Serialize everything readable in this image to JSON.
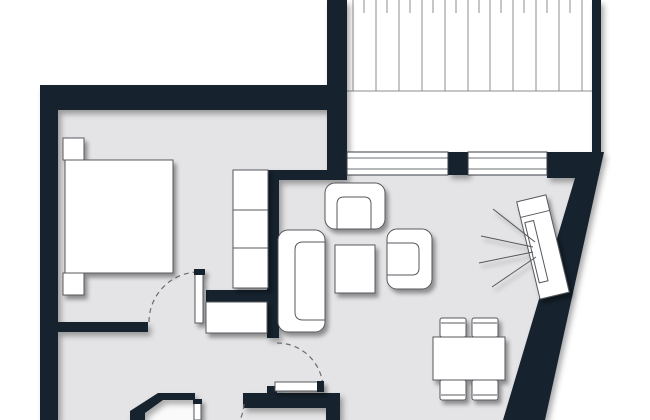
{
  "meta": {
    "type": "architectural-floor-plan",
    "description": "Top-down apartment floor plan with bedroom, living-dining area, hallway, terrace with decking, and a slanted exterior wall"
  },
  "colors": {
    "wall": "#15232e",
    "floor": "#e4e4e6",
    "outside": "#ffffff",
    "terrace_fill": "#ffffff",
    "room_white": "#fafafa",
    "furniture_fill": "#ffffff",
    "furniture_stroke": "#55585c",
    "drawing_line": "#8a8d90",
    "window_line": "#3a3f45",
    "arc": "#6a6d70"
  },
  "architecture": {
    "exterior": [
      "top-wall",
      "left-wall",
      "slanted-right-wall",
      "terrace-left-wall",
      "terrace-right-wall"
    ],
    "windows": [
      "window-left-pane",
      "window-right-pane",
      "window-pillar"
    ],
    "interior_walls": [
      "bedroom-south-wall",
      "bedroom-east-wall",
      "living-top-wall",
      "closet-nook-wall",
      "bathroom-wall-chamfered",
      "kitchen-wall"
    ],
    "doors": [
      "bedroom-door",
      "hall-kitchen-door",
      "hall-bathroom-door"
    ],
    "terrace": "decking-planks"
  },
  "furniture": [
    "double-bed",
    "nightstand-top",
    "nightstand-bottom",
    "wardrobe-3-sections",
    "hall-closet",
    "sofa",
    "armchair-top",
    "armchair-right",
    "coffee-table",
    "tv-sideboard",
    "tv-screen",
    "dining-table",
    "dining-chair-1",
    "dining-chair-2",
    "dining-chair-3",
    "dining-chair-4"
  ]
}
